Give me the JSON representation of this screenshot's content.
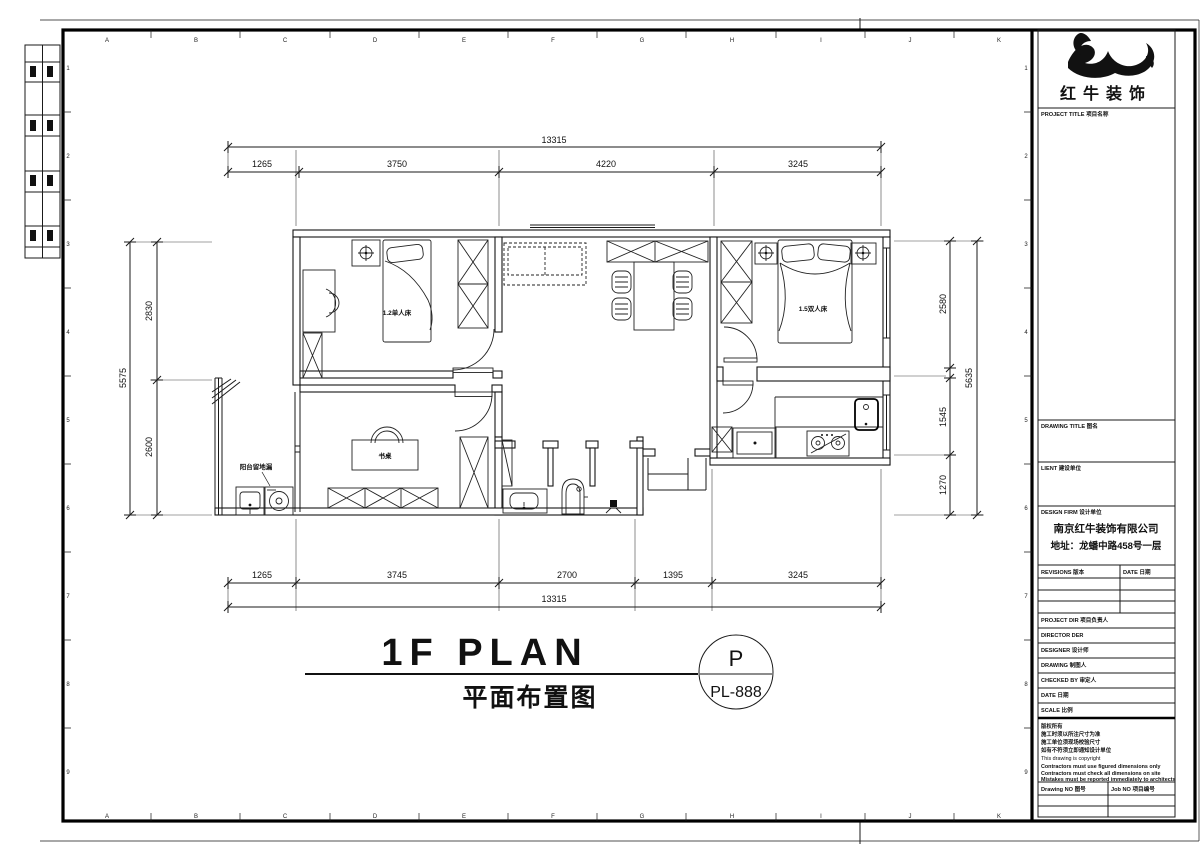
{
  "sheet": {
    "grid_letters": [
      "A",
      "B",
      "C",
      "D",
      "E",
      "F",
      "G",
      "H",
      "I",
      "J",
      "K"
    ],
    "grid_numbers": [
      "1",
      "2",
      "3",
      "4",
      "5",
      "6",
      "7",
      "8",
      "9"
    ]
  },
  "dims": {
    "top_overall": "13315",
    "top": [
      "1265",
      "3750",
      "4220",
      "3245"
    ],
    "bottom": [
      "1265",
      "3745",
      "2700",
      "1395",
      "3245"
    ],
    "bottom_overall": "13315",
    "left_total": "5575",
    "left": [
      "2830",
      "2600"
    ],
    "right": [
      "2580",
      "1545",
      "1270"
    ],
    "right_total": "5635"
  },
  "plan_labels": {
    "bed1": "1.2单人床",
    "bed2": "1.5双人床",
    "desk": "书桌",
    "balcony_note": "阳台留地漏"
  },
  "title": {
    "main": "1F PLAN",
    "sub": "平面布置图",
    "bubble_letter": "P",
    "bubble_code": "PL-888"
  },
  "title_block": {
    "brand": "红牛装饰",
    "project_title": "PROJECT TITLE  项目名称",
    "drawing_title": "DRAWING TITLE  图名",
    "client": "LIENT  建设单位",
    "design_firm": "DESIGN FIRM  设计单位",
    "firm_name": "南京红牛装饰有限公司",
    "firm_address": "地址：龙蟠中路458号一层",
    "revisions": "REVISIONS  版本",
    "date_col": "DATE  日期",
    "project_dir": "PROJECT DIR  项目负责人",
    "director": "DIRECTOR DER",
    "designer": "DESIGNER  设计师",
    "drawing_by": "DRAWING  制图人",
    "checked_by": "CHECKED BY  审定人",
    "date": "DATE  日期",
    "scale": "SCALE  比例",
    "notes": [
      "版权所有",
      "施工时须以所注尺寸为准",
      "施工单位须现场校验尺寸",
      "如有不符须立即通知设计单位",
      "This drawing is copyright",
      "Contractors must use figured dimensions only",
      "Contractors must check all dimensions on site",
      "Mistakes must be reported immediately to architects"
    ],
    "drawing_no": "Drawing NO  图号",
    "job_no": "Job NO  项目编号"
  }
}
